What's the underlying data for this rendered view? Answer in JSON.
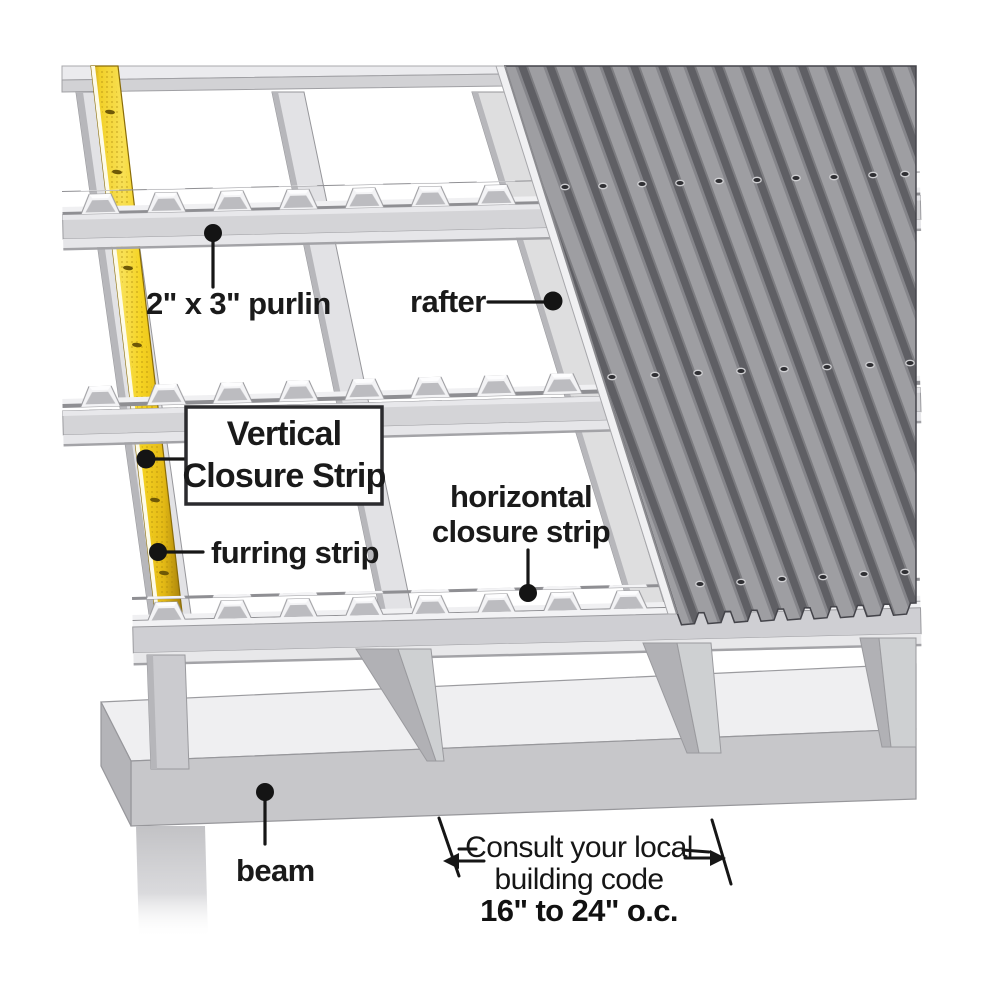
{
  "figure": {
    "type": "construction-diagram",
    "subject": "Corrugated metal roof panel installation over purlins and rafters",
    "labels": {
      "purlin": "2\" x 3\" purlin",
      "rafter": "rafter",
      "vertical_closure_line1": "Vertical",
      "vertical_closure_line2": "Closure Strip",
      "horizontal_closure_line1": "horizontal",
      "horizontal_closure_line2": "closure strip",
      "furring_strip": "furring strip",
      "beam": "beam"
    },
    "dimension_note": {
      "line1": "Consult your local",
      "line2": "building code",
      "line3": "16\" to 24\" o.c."
    },
    "colors": {
      "background": "#ffffff",
      "ink": "#1a1a1a",
      "furring_strip_yellow": "#f5d122",
      "furring_strip_gold_edge": "#c79e10",
      "panel_stripe_dark": "#5f5f64",
      "panel_stripe_light": "#9e9ea2",
      "frame_light": "#e4e4e7",
      "frame_mid": "#d4d4d7",
      "beam_face": "#c7c7ca",
      "beam_top": "#efeff1"
    }
  }
}
